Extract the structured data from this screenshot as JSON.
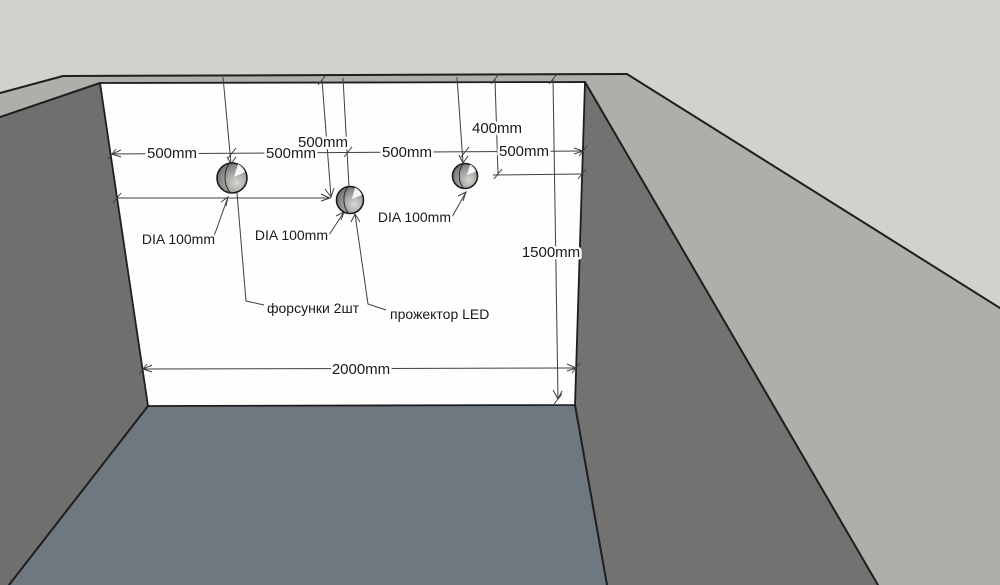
{
  "scene": {
    "description": "3D CAD view of a pool corner with a dimensioned back wall containing two nozzle holes and one LED projector hole",
    "colors": {
      "deck": "#d2d2cd",
      "rim": "#aeaeaa",
      "wall_left": "#6f6f6e",
      "wall_right": "#727271",
      "back_wall": "#fefefe",
      "floor": "#6f7880",
      "edge": "#1e1e1e",
      "dim": "#3f3f3f",
      "text": "#1a1a1a"
    }
  },
  "dimensions": {
    "chain": {
      "seg1": "500mm",
      "seg2": "500mm",
      "seg3": "500mm",
      "seg4": "500mm"
    },
    "projector_depth": "500mm",
    "nozzle_depth": "400mm",
    "wall_height": "1500mm",
    "wall_width": "2000mm"
  },
  "annotations": {
    "dia_nozzle_1": "DIA 100mm",
    "dia_projector": "DIA 100mm",
    "dia_nozzle_2": "DIA 100mm",
    "nozzles_label": "форсунки 2шт",
    "projector_label": "прожектор LED"
  }
}
